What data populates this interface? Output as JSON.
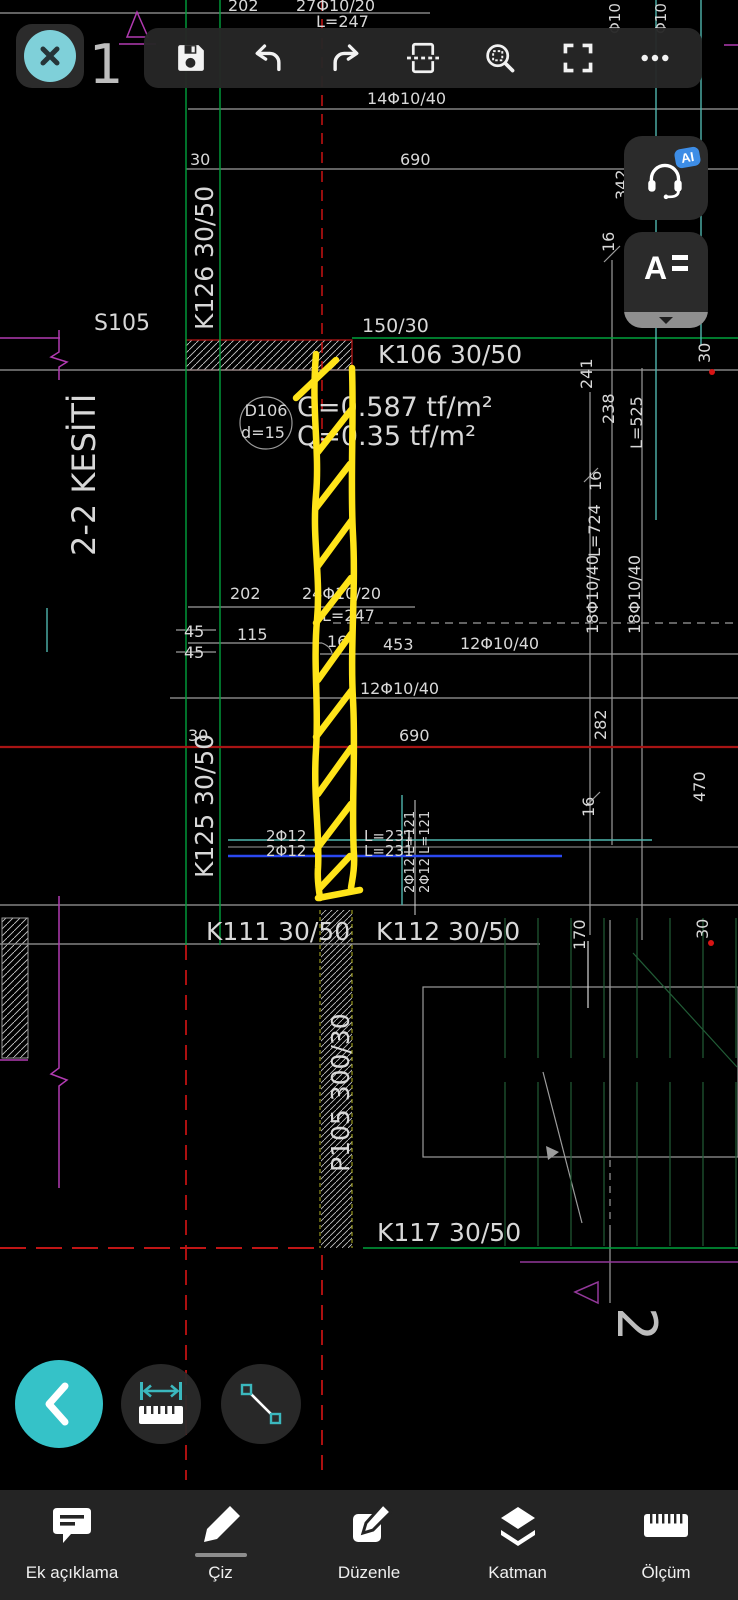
{
  "colors": {
    "drawing_text": "#d8d8d8",
    "annotation_yellow": "#ffe419",
    "axis_green": "#00a13c",
    "stair_green": "#215c36",
    "cad_teal": "#4fb5ad",
    "cad_blue": "#2b48f0",
    "cad_red": "#d81414",
    "dark_red": "#a81414",
    "cad_magenta": "#b13ab1",
    "accent_teal": "#35c2c8",
    "ai_badge_blue": "#3d8de6",
    "toolbar_bg": "#272727"
  },
  "toolbar": {
    "buttons": [
      "save",
      "undo",
      "redo",
      "page-section",
      "zoom-selection",
      "fullscreen",
      "more"
    ]
  },
  "side_buttons": {
    "ai_badge": "AI",
    "reader_glyph": "A",
    "items": [
      "ai-assistant",
      "text-reader"
    ]
  },
  "floating_tools": [
    "back",
    "measure-distance",
    "draw-line"
  ],
  "bottom_nav": {
    "active": "Çiz",
    "items": [
      {
        "id": "annotation",
        "label": "Ek açıklama"
      },
      {
        "id": "draw",
        "label": "Çiz"
      },
      {
        "id": "edit",
        "label": "Düzenle"
      },
      {
        "id": "layers",
        "label": "Katman"
      },
      {
        "id": "measure",
        "label": "Ölçüm"
      }
    ]
  },
  "annotation": {
    "type": "freehand-highlight",
    "color": "#ffe419"
  },
  "drawing": {
    "section_title": "2-2 KESİTİ",
    "labels": [
      {
        "text": "202",
        "x": 228,
        "y": 11,
        "size": 16
      },
      {
        "text": "27Φ10/20",
        "x": 296,
        "y": 11,
        "size": 16
      },
      {
        "text": "L=247",
        "x": 316,
        "y": 27,
        "size": 16
      },
      {
        "text": "Φ10",
        "x": 620,
        "y": 34,
        "size": 15,
        "rot": -90
      },
      {
        "text": "Φ10",
        "x": 666,
        "y": 34,
        "size": 15,
        "rot": -90
      },
      {
        "text": "14Φ10/40",
        "x": 367,
        "y": 104,
        "size": 16
      },
      {
        "text": "30",
        "x": 190,
        "y": 165,
        "size": 16
      },
      {
        "text": "690",
        "x": 400,
        "y": 165,
        "size": 16
      },
      {
        "text": "342",
        "x": 627,
        "y": 200,
        "size": 16,
        "rot": -90
      },
      {
        "text": "16",
        "x": 614,
        "y": 252,
        "size": 16,
        "rot": -90
      },
      {
        "text": "K126 30/50",
        "x": 213,
        "y": 330,
        "size": 25,
        "rot": -90
      },
      {
        "text": "S105",
        "x": 94,
        "y": 330,
        "size": 22
      },
      {
        "text": "150/30",
        "x": 362,
        "y": 332,
        "size": 19
      },
      {
        "text": "K106 30/50",
        "x": 378,
        "y": 363,
        "size": 25
      },
      {
        "text": "30",
        "x": 710,
        "y": 363,
        "size": 16,
        "rot": -90
      },
      {
        "text": "241",
        "x": 592,
        "y": 389,
        "size": 16,
        "rot": -90
      },
      {
        "text": "238",
        "x": 614,
        "y": 424,
        "size": 16,
        "rot": -90
      },
      {
        "text": "L=525",
        "x": 642,
        "y": 449,
        "size": 16,
        "rot": -90
      },
      {
        "text": "D106",
        "x": 266,
        "y": 416,
        "size": 16,
        "anchor": "middle"
      },
      {
        "text": "d=15",
        "x": 263,
        "y": 438,
        "size": 16,
        "anchor": "middle"
      },
      {
        "text": "G=0.587 tf/m²",
        "x": 297,
        "y": 416,
        "size": 27
      },
      {
        "text": "Q=0.35 tf/m²",
        "x": 297,
        "y": 445,
        "size": 27
      },
      {
        "text": "16",
        "x": 601,
        "y": 491,
        "size": 16,
        "rot": -90
      },
      {
        "text": "L=724",
        "x": 600,
        "y": 557,
        "size": 16,
        "rot": -90
      },
      {
        "text": "18Φ10/40",
        "x": 598,
        "y": 634,
        "size": 16,
        "rot": -90
      },
      {
        "text": "18Φ10/40",
        "x": 640,
        "y": 634,
        "size": 16,
        "rot": -90
      },
      {
        "text": "202",
        "x": 230,
        "y": 599,
        "size": 16
      },
      {
        "text": "24Φ10/20",
        "x": 302,
        "y": 599,
        "size": 16
      },
      {
        "text": "L=247",
        "x": 322,
        "y": 621,
        "size": 16
      },
      {
        "text": "45",
        "x": 184,
        "y": 637,
        "size": 16
      },
      {
        "text": "115",
        "x": 237,
        "y": 640,
        "size": 16
      },
      {
        "text": "45",
        "x": 184,
        "y": 658,
        "size": 16
      },
      {
        "text": "16",
        "x": 327,
        "y": 647,
        "size": 16
      },
      {
        "text": "453",
        "x": 383,
        "y": 650,
        "size": 16
      },
      {
        "text": "12Φ10/40",
        "x": 460,
        "y": 649,
        "size": 16
      },
      {
        "text": "12Φ10/40",
        "x": 360,
        "y": 694,
        "size": 16
      },
      {
        "text": "30",
        "x": 188,
        "y": 741,
        "size": 16
      },
      {
        "text": "690",
        "x": 399,
        "y": 741,
        "size": 16
      },
      {
        "text": "282",
        "x": 606,
        "y": 740,
        "size": 16,
        "rot": -90
      },
      {
        "text": "K125 30/50",
        "x": 213,
        "y": 878,
        "size": 25,
        "rot": -90
      },
      {
        "text": "16",
        "x": 594,
        "y": 817,
        "size": 16,
        "rot": -90
      },
      {
        "text": "470",
        "x": 705,
        "y": 802,
        "size": 16,
        "rot": -90
      },
      {
        "text": "2Φ12",
        "x": 266,
        "y": 841,
        "size": 15
      },
      {
        "text": "L=231",
        "x": 364,
        "y": 841,
        "size": 15
      },
      {
        "text": "2Φ12",
        "x": 266,
        "y": 856,
        "size": 15
      },
      {
        "text": "L=231",
        "x": 364,
        "y": 856,
        "size": 15
      },
      {
        "text": "2Φ12 L=121",
        "x": 414,
        "y": 893,
        "size": 13,
        "rot": -90
      },
      {
        "text": "2Φ12 L=121",
        "x": 429,
        "y": 893,
        "size": 13,
        "rot": -90
      },
      {
        "text": "K111 30/50",
        "x": 206,
        "y": 940,
        "size": 25
      },
      {
        "text": "K112 30/50",
        "x": 376,
        "y": 940,
        "size": 25
      },
      {
        "text": "170",
        "x": 585,
        "y": 950,
        "size": 16,
        "rot": -90
      },
      {
        "text": "30",
        "x": 708,
        "y": 939,
        "size": 16,
        "rot": -90
      },
      {
        "text": "P105 300/30",
        "x": 349,
        "y": 1172,
        "size": 25,
        "rot": -90
      },
      {
        "text": "K117 30/50",
        "x": 377,
        "y": 1241,
        "size": 25
      },
      {
        "text": "2-2 KESİTİ",
        "x": 95,
        "y": 556,
        "size": 32,
        "rot": -90
      },
      {
        "text": "1",
        "x": 89,
        "y": 83,
        "size": 54,
        "color": "#bdbdbd"
      },
      {
        "text": "2",
        "x": 618,
        "y": 1307,
        "size": 54,
        "rot": 90,
        "color": "#bdbdbd"
      }
    ]
  }
}
